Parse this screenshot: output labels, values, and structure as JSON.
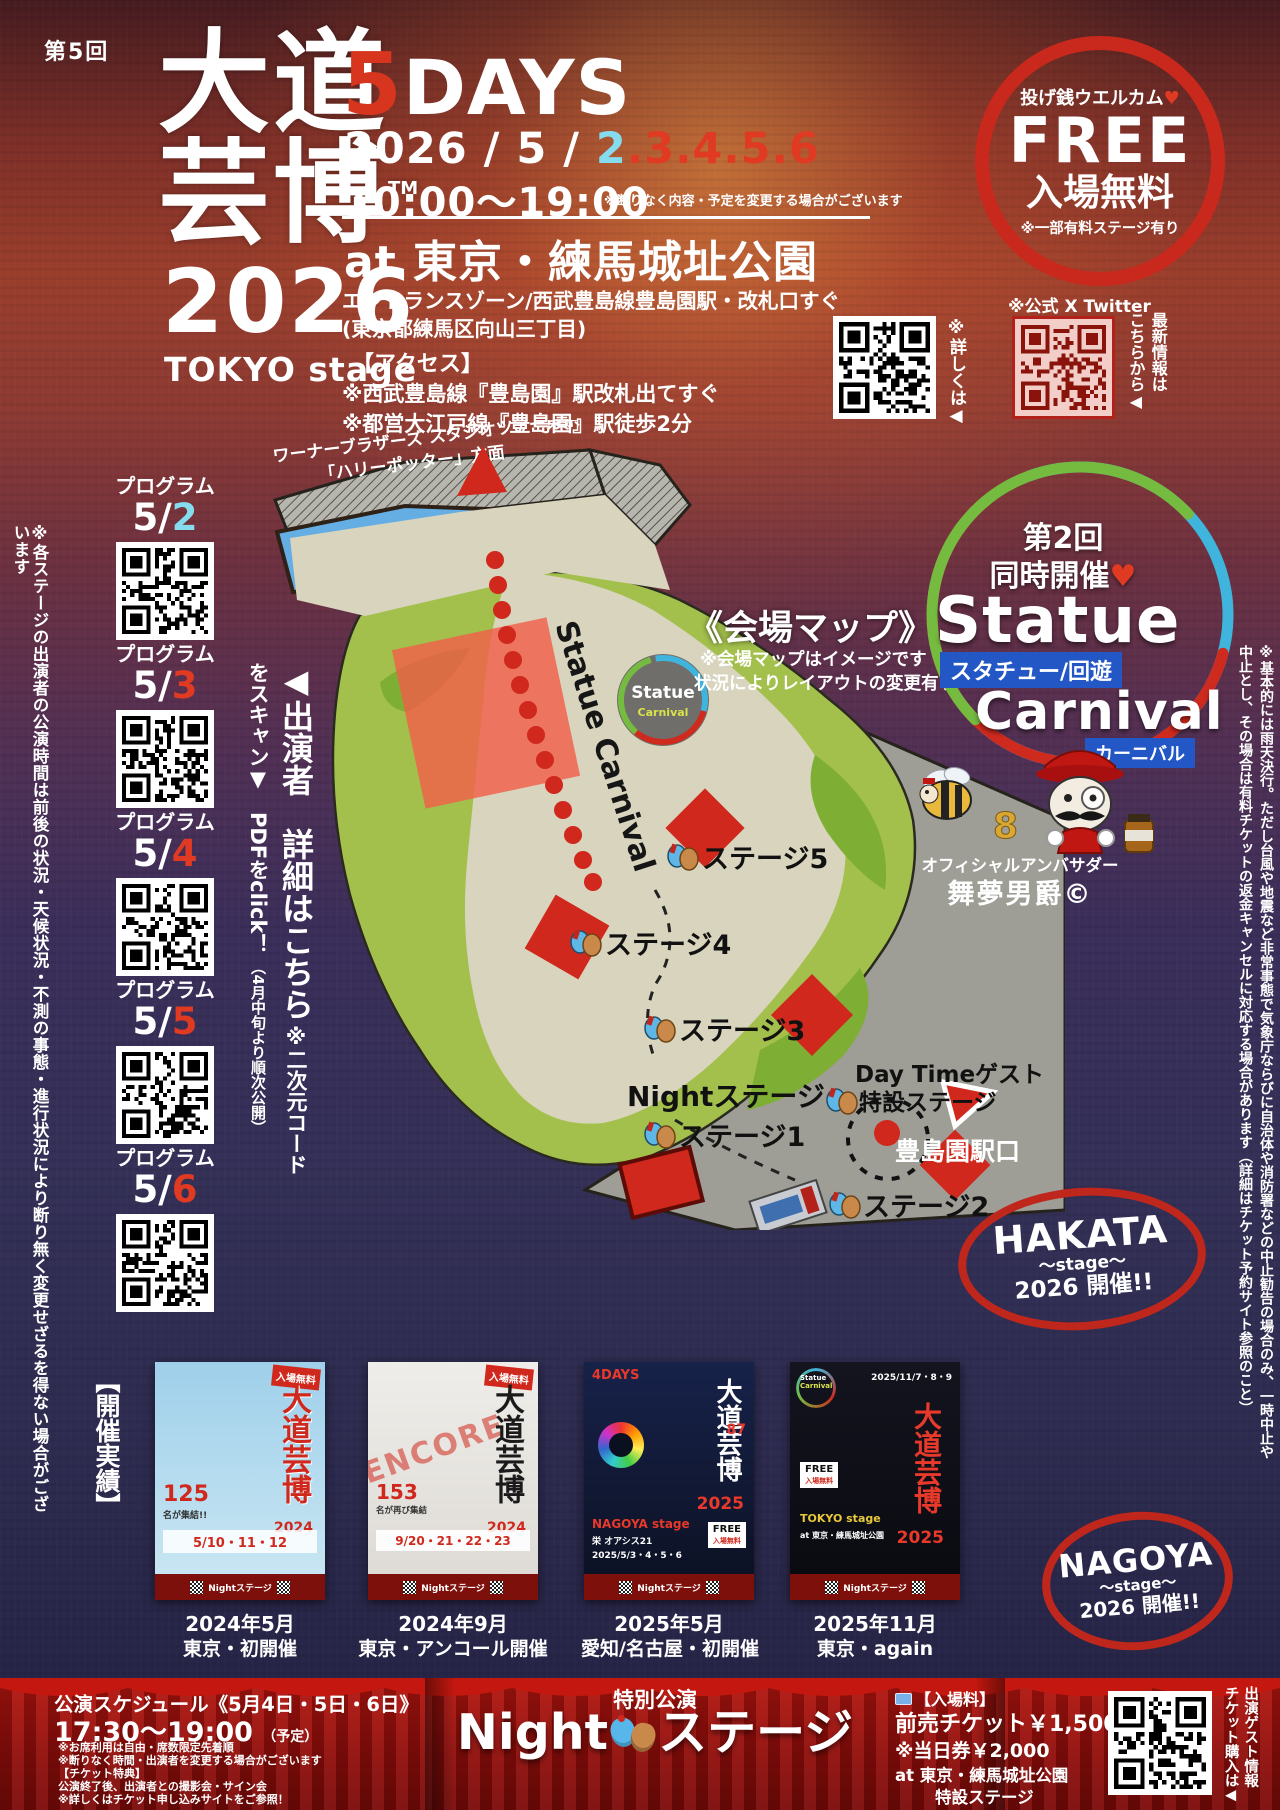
{
  "colors": {
    "accent_red": "#d0281c",
    "accent_cyan": "#86dcef",
    "curtain_red": "#a3120d",
    "map_green": "#a3c04c",
    "map_path": "#d8d4bd",
    "statue_label_blue": "#2257c5"
  },
  "poster": {
    "edition": "第5回",
    "title_row1": "大道",
    "title_row2": "芸博",
    "tm": "TM",
    "year": "2026",
    "stage": "TOKYO stage"
  },
  "event": {
    "days_num": "5",
    "days_word": "DAYS",
    "date_prefix": "2026 / 5 / ",
    "date_day1": "2",
    "date_days_rest": ".3.4.5.6",
    "time": "10:00～19:00",
    "time_note": "※断りなく内容・予定を変更する場合がございます",
    "venue": "at 東京・練馬城址公園",
    "venue_sub1": "エントランスゾーン/西武豊島線豊島園駅・改札口すぐ",
    "venue_sub2": "(東京都練馬区向山三丁目)",
    "access_title": "【アクセス】",
    "access_line1": "※西武豊島線『豊島園』駅改札出てすぐ",
    "access_line2": "※都営大江戸線『豊島園』駅徒歩2分"
  },
  "free_badge": {
    "welcome": "投げ銭ウエルカム",
    "heart": "♥",
    "free_en": "FREE",
    "free_jp": "入場無料",
    "note": "※一部有料ステージ有り"
  },
  "qr_info": {
    "details_note": "※詳しくは◀",
    "x_official": "※公式 X Twitter",
    "x_note": "最新情報は\nこちらから◀"
  },
  "programs": {
    "label": "プログラム",
    "items": [
      {
        "prefix": "5/",
        "day": "2"
      },
      {
        "prefix": "5/",
        "day": "3"
      },
      {
        "prefix": "5/",
        "day": "4"
      },
      {
        "prefix": "5/",
        "day": "5"
      },
      {
        "prefix": "5/",
        "day": "6"
      }
    ]
  },
  "left_note": "※各ステージの出演者の公演時間は前後の状況・天候状況・不測の事態・進行状況により断り無く変更せざるを得ない場合がございます",
  "performers_note": {
    "main": "◀出演者　詳細はこちら",
    "sub": "※二次元コードをスキャン▼　PDFをclick！",
    "sub2": "（4月中旬より順次公開）"
  },
  "map": {
    "title": "《会場マップ》",
    "note1": "※会場マップはイメージです",
    "note2": "状況によりレイアウトの変更有り",
    "warner_line1": "ワーナーブラザーズ スタジオツアー東京",
    "warner_line2": "「ハリーポッター」方面",
    "trail": "Statue Carnival",
    "badge_line1": "Statue",
    "badge_line2": "Carnival",
    "stage5": "ステージ5",
    "stage4": "ステージ4",
    "stage3": "ステージ3",
    "night": "Nightステージ",
    "stage1": "ステージ1",
    "stage2": "ステージ2",
    "daytime_guest": "Day Timeゲスト",
    "special_stage": "特設ステージ",
    "station": "豊島園駅口"
  },
  "statue_carnival": {
    "round1": "第2回",
    "round2": "同時開催",
    "heart": "♥",
    "name1": "Statue",
    "name1_jp": "スタチュー/回遊",
    "name2": "Carnival",
    "name2_jp": "カーニバル",
    "ambassador": "オフィシャルアンバサダー",
    "mascot_name": "舞夢男爵©"
  },
  "right_note": "※基本的には雨天決行。ただし台風や地震など非常事態で気象庁ならびに自治体や消防署などの中止勧告の場合のみ、一時中止や中止とし、その場合は有料チケットの返金キャンセルに対応する場合があります（詳細はチケット予約サイト参照のこと）",
  "history": {
    "label": "【開催実績】",
    "posters": [
      {
        "badge": "入場無料",
        "title": "大道芸博",
        "year": "2024",
        "count": "125",
        "count_suffix": "名が集結!!",
        "dates": "5/10・11・12",
        "band": "Nightステージ",
        "caption1": "2024年5月",
        "caption2": "東京・初開催"
      },
      {
        "badge": "入場無料",
        "overlay": "ENCORE",
        "title": "大道芸博",
        "year": "2024",
        "count": "153",
        "count_suffix": "名が再び集結",
        "dates": "9/20・21・22・23",
        "band": "Nightステージ",
        "caption1": "2024年9月",
        "caption2": "東京・アンコール開催"
      },
      {
        "title": "大道芸博",
        "year": "2025",
        "stage": "NAGOYA stage",
        "venue": "栄 オアシス21",
        "days": "4DAYS",
        "dates": "2025/5/3・4・5・6",
        "count": "87",
        "free": "FREE",
        "free_jp": "入場無料",
        "band": "Nightステージ",
        "caption1": "2025年5月",
        "caption2": "愛知/名古屋・初開催"
      },
      {
        "logo1": "Statue",
        "logo2": "Carnival",
        "title": "大道芸博",
        "year": "2025",
        "stage": "TOKYO stage",
        "venue": "at 東京・練馬城址公園",
        "dates": "2025/11/7・8・9",
        "free": "FREE",
        "free_jp": "入場無料",
        "band": "Nightステージ",
        "caption1": "2025年11月",
        "caption2": "東京・again"
      }
    ]
  },
  "stamps": {
    "hakata_name": "HAKATA",
    "hakata_stage": "～stage～",
    "hakata_year": "2026 開催!!",
    "nagoya_name": "NAGOYA",
    "nagoya_stage": "～stage～",
    "nagoya_year": "2026 開催!!"
  },
  "night_stage": {
    "schedule": "公演スケジュール《5月4日・5日・6日》",
    "time": "17:30～19:00",
    "time_note": "（予定）",
    "notes": [
      "※お席利用は自由・席数限定先着順",
      "※断りなく時間・出演者を変更する場合がございます",
      "【チケット特典】",
      "公演終了後、出演者との撮影会・サイン会",
      "※詳しくはチケット申し込みサイトをご参照！"
    ],
    "special": "特別公演",
    "title_en": "Night",
    "title_jp": "ステージ",
    "price_title": "【入場料】",
    "price_advance": "前売チケット￥1,500",
    "price_door": "※当日券￥2,000",
    "price_venue": "at 東京・練馬城址公園",
    "price_stage": "特設ステージ",
    "qr_note": "出演ゲスト情報\nチケット購入は◀"
  }
}
